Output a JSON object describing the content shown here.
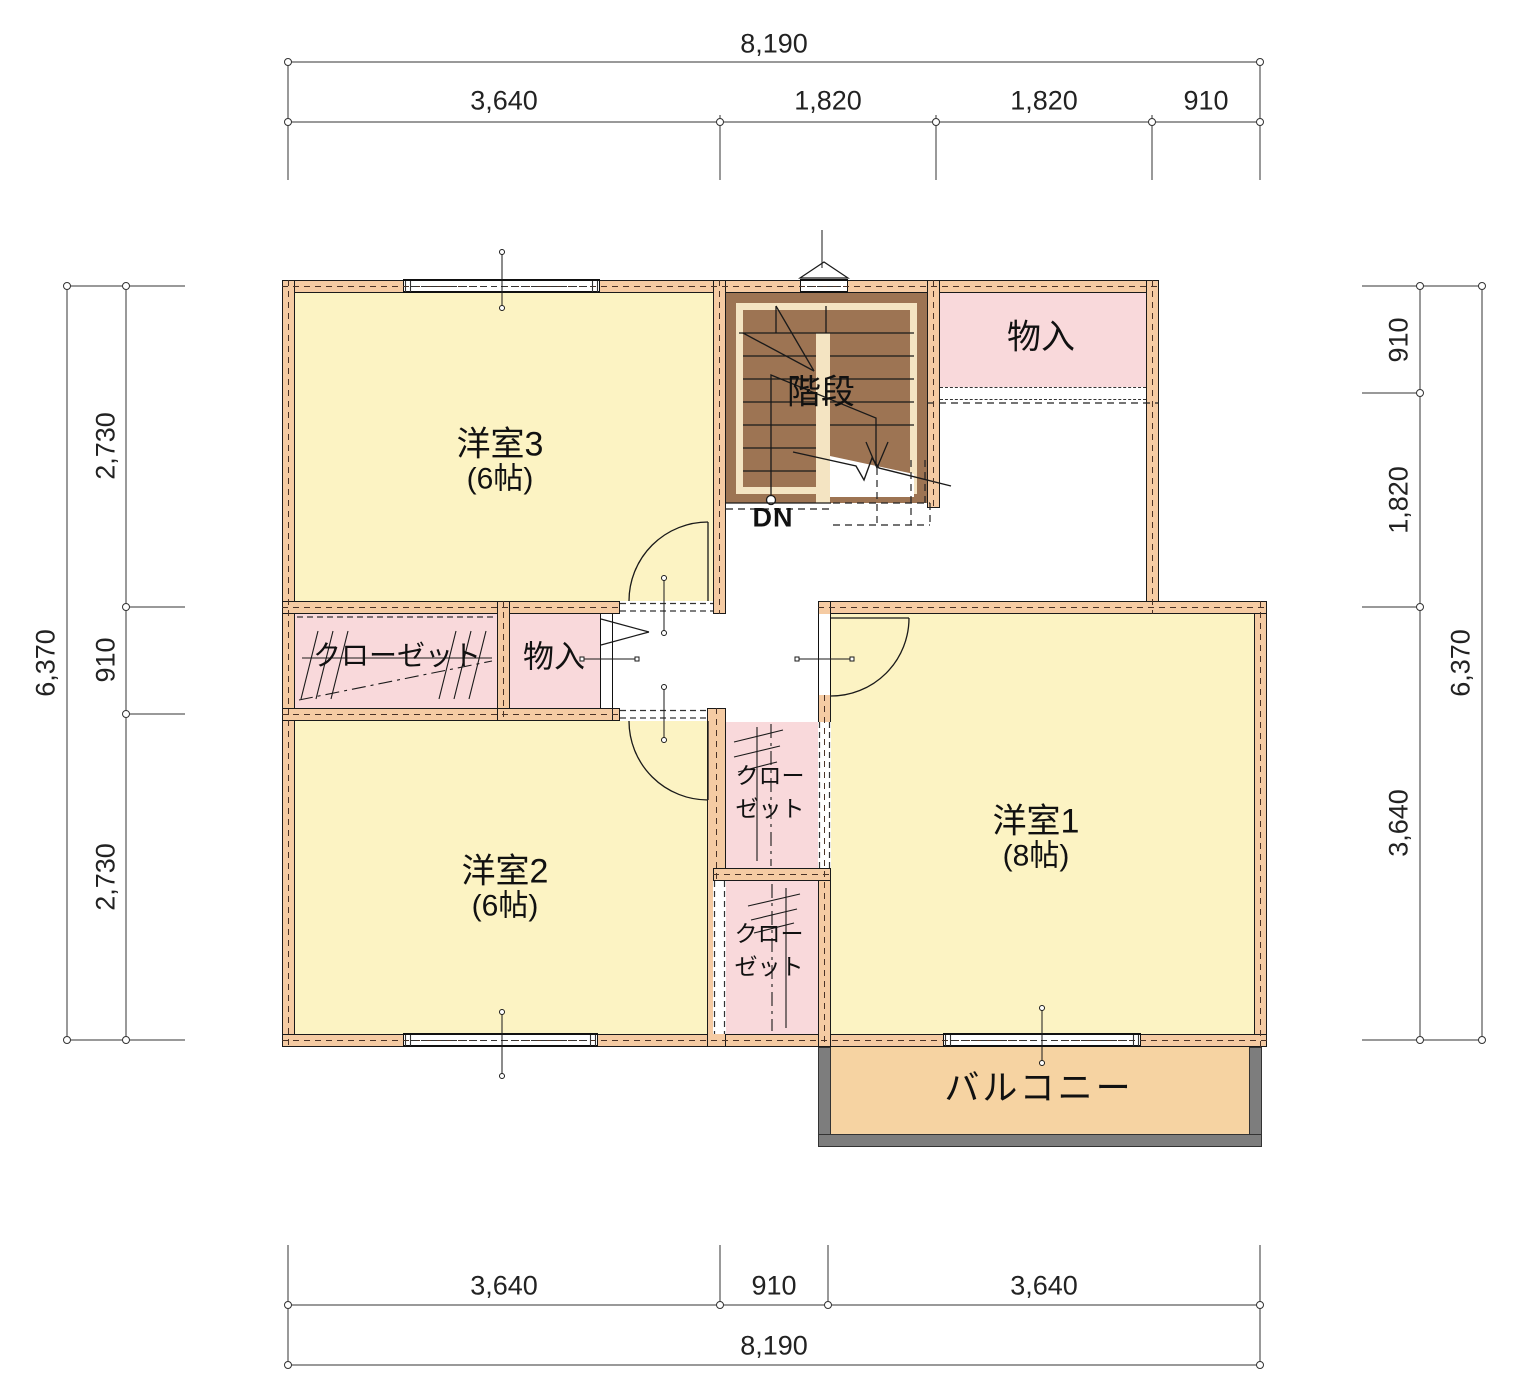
{
  "rooms": {
    "room3": {
      "name": "洋室3",
      "size": "(6帖)"
    },
    "room2": {
      "name": "洋室2",
      "size": "(6帖)"
    },
    "room1": {
      "name": "洋室1",
      "size": "(8帖)"
    },
    "stairs": {
      "name": "階段",
      "direction": "DN"
    },
    "storage_top": {
      "name": "物入"
    },
    "storage_hall": {
      "name": "物入"
    },
    "closet_main": {
      "name": "クローゼット"
    },
    "closet_upper": {
      "name_line1": "クロー",
      "name_line2": "ゼット"
    },
    "closet_lower": {
      "name_line1": "クロー",
      "name_line2": "ゼット"
    },
    "balcony": {
      "name": "バルコニー"
    }
  },
  "dimensions": {
    "top": {
      "total": "8,190",
      "segments": [
        "3,640",
        "1,820",
        "1,820",
        "910"
      ]
    },
    "bottom": {
      "total": "8,190",
      "segments": [
        "3,640",
        "910",
        "3,640"
      ]
    },
    "left": {
      "total": "6,370",
      "segments": [
        "2,730",
        "910",
        "2,730"
      ]
    },
    "right": {
      "total": "6,370",
      "segments": [
        "910",
        "1,820",
        "3,640"
      ]
    }
  },
  "colors": {
    "room_fill": "#fcf3c3",
    "closet_fill": "#f9d9db",
    "wall_fill": "#f5cba3",
    "stair_fill": "#9d7453",
    "stair_inner": "#f4e4c2",
    "balcony_fill": "#f6d3a2",
    "railing_gray": "#7d7d7d",
    "line": "#1a1a1a"
  }
}
